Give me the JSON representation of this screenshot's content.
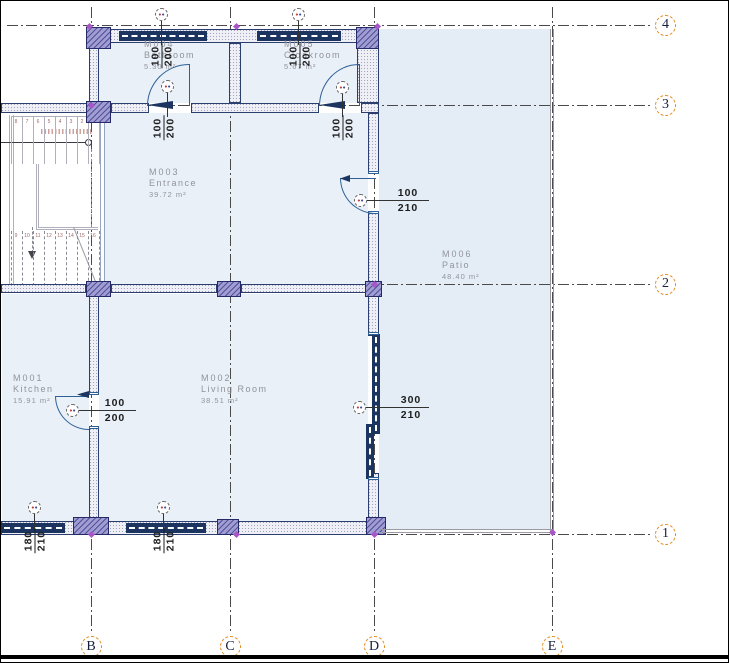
{
  "drawing": {
    "type": "architectural-floor-plan"
  },
  "colors": {
    "room_fill": "#e9f0f8",
    "patio_fill": "#e4edf6",
    "wall_outline": "#2a3f6e",
    "window_band": "#1b3560",
    "stipple_fill": "#efeff6",
    "column_fill": "#a09dd3",
    "column_hatch": "#54509a",
    "grid_line": "#4a4a4a",
    "grid_bubble_border": "#e08a20",
    "grid_bubble_text": "#151f3c",
    "room_label": "#92939b",
    "dim_text": "#1d1d1d",
    "door_arc": "#2e6096",
    "stair_line": "#b0b0bc",
    "snap_marker": "#a855c8"
  },
  "rooms": [
    {
      "code": "M001",
      "name": "Kitchen",
      "area": "15.91 m²",
      "x": 12,
      "y": 372
    },
    {
      "code": "M002",
      "name": "Living Room",
      "area": "38.51 m²",
      "x": 200,
      "y": 372
    },
    {
      "code": "M003",
      "name": "Entrance",
      "area": "39.72 m²",
      "x": 148,
      "y": 166
    },
    {
      "code": "M004",
      "name": "Bathroom",
      "area": "5.30 m²",
      "x": 143,
      "y": 38
    },
    {
      "code": "M005",
      "name": "Cloakroom",
      "area": "5.67 m²",
      "x": 283,
      "y": 38
    },
    {
      "code": "M006",
      "name": "Patio",
      "area": "48.40 m²",
      "x": 441,
      "y": 248
    }
  ],
  "grid": {
    "columns": [
      {
        "label": "B",
        "x": 90
      },
      {
        "label": "C",
        "x": 229
      },
      {
        "label": "D",
        "x": 373
      },
      {
        "label": "E",
        "x": 551
      }
    ],
    "rows": [
      {
        "label": "4",
        "y": 24
      },
      {
        "label": "3",
        "y": 104
      },
      {
        "label": "2",
        "y": 283
      },
      {
        "label": "1",
        "y": 533
      }
    ]
  },
  "dimensions": {
    "horizontal": [
      {
        "id": "kitchen-door",
        "width": "100",
        "height": "200",
        "bubble": [
          71,
          409
        ],
        "line_to": 135,
        "text_cx": 114
      },
      {
        "id": "entrance-door",
        "width": "100",
        "height": "210",
        "bubble": [
          359,
          199
        ],
        "line_to": 428,
        "text_cx": 407
      },
      {
        "id": "living-room-slider",
        "width": "300",
        "height": "210",
        "bubble": [
          358,
          406
        ],
        "line_to": 428,
        "text_cx": 410
      }
    ],
    "vertical": [
      {
        "id": "bathroom-window",
        "width": "100",
        "height": "200",
        "cx": 161,
        "cy": 55,
        "bubble": [
          160,
          13
        ]
      },
      {
        "id": "cloakroom-window",
        "width": "100",
        "height": "200",
        "cx": 299,
        "cy": 55,
        "bubble": [
          297,
          13
        ]
      },
      {
        "id": "bathroom-door",
        "width": "100",
        "height": "200",
        "cx": 163,
        "cy": 127,
        "bubble": [
          166,
          85
        ]
      },
      {
        "id": "cloakroom-door",
        "width": "100",
        "height": "200",
        "cx": 342,
        "cy": 127,
        "bubble": [
          341,
          86
        ]
      },
      {
        "id": "window-left",
        "width": "180",
        "height": "210",
        "cx": 34,
        "cy": 540,
        "bubble": [
          33,
          506
        ]
      },
      {
        "id": "window-mid",
        "width": "180",
        "height": "210",
        "cx": 163,
        "cy": 540,
        "bubble": [
          162,
          506
        ]
      }
    ]
  },
  "stairs": {
    "upper_treads": [
      "8",
      "7",
      "6",
      "5",
      "4",
      "3",
      "2",
      "1"
    ],
    "lower_treads": [
      "9",
      "10",
      "11",
      "12",
      "13",
      "14",
      "15",
      "16"
    ]
  },
  "snap_markers": [
    [
      88,
      25
    ],
    [
      235,
      25
    ],
    [
      376,
      25
    ],
    [
      90,
      104
    ],
    [
      373,
      283
    ],
    [
      90,
      533
    ],
    [
      235,
      533
    ],
    [
      373,
      533
    ],
    [
      551,
      531
    ]
  ]
}
